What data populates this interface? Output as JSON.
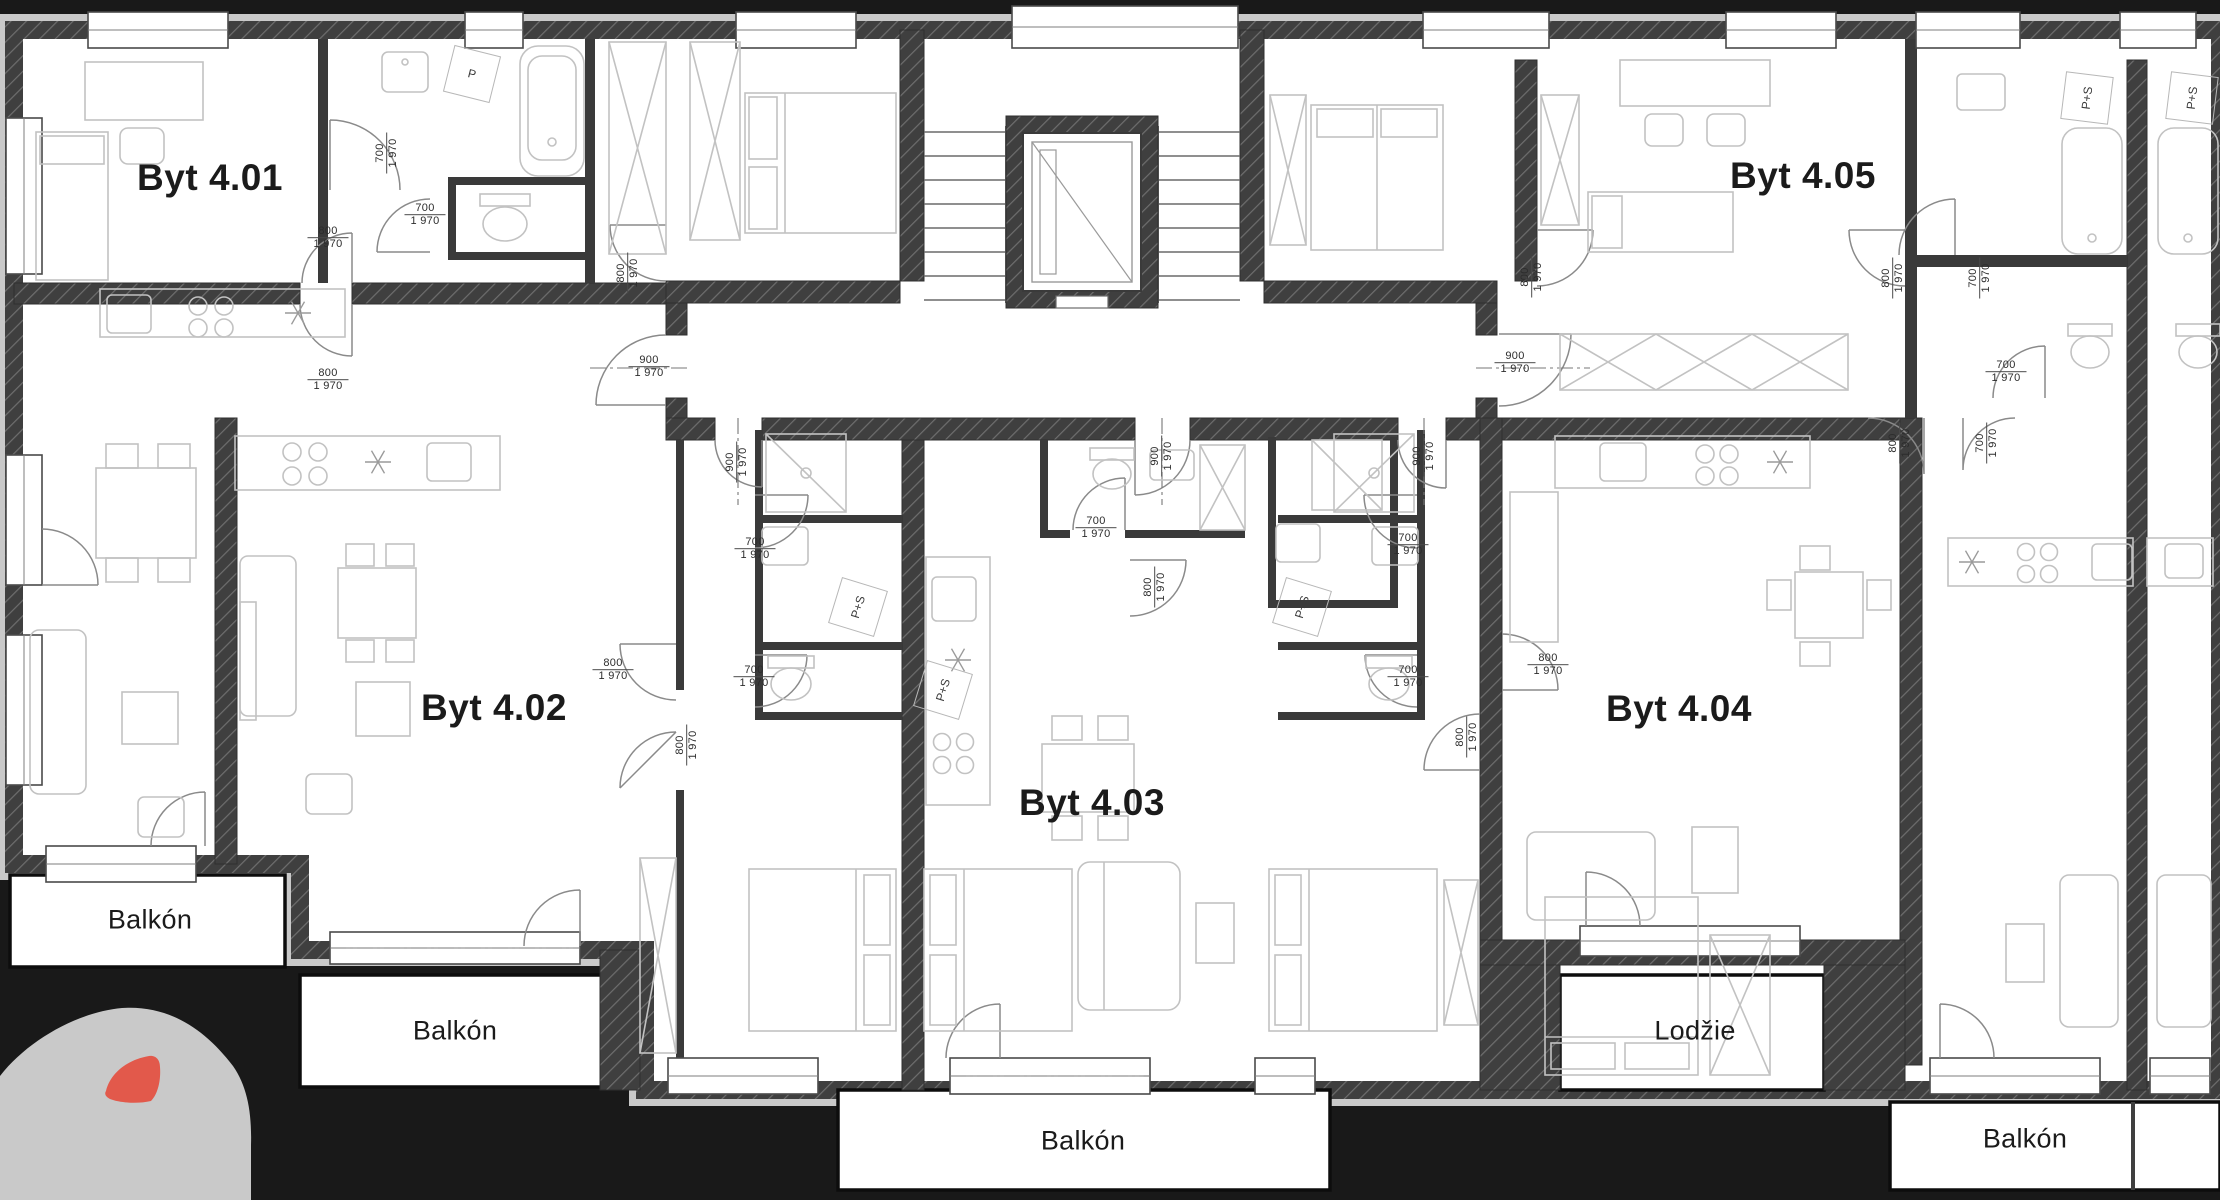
{
  "colors": {
    "background": "#191919",
    "paper": "#ffffff",
    "wall_dark": "#3f3f3f",
    "wall_hatch_line": "#6e6e6e",
    "insulation_band": "#c9c9c9",
    "furniture_line": "#c2c2c2",
    "text": "#1b1b1b",
    "logo_gray": "#c9c9c9",
    "logo_red": "#e2594b"
  },
  "apartments": [
    {
      "label": "Byt 4.01",
      "x": 210,
      "y": 178
    },
    {
      "label": "Byt 4.02",
      "x": 494,
      "y": 708
    },
    {
      "label": "Byt 4.03",
      "x": 1092,
      "y": 803
    },
    {
      "label": "Byt 4.04",
      "x": 1679,
      "y": 709
    },
    {
      "label": "Byt 4.05",
      "x": 1803,
      "y": 176
    }
  ],
  "balconies": [
    {
      "label": "Balkón",
      "x": 150,
      "y": 920
    },
    {
      "label": "Balkón",
      "x": 455,
      "y": 1031
    },
    {
      "label": "Balkón",
      "x": 1083,
      "y": 1141
    },
    {
      "label": "Lodžie",
      "x": 1695,
      "y": 1031
    },
    {
      "label": "Balkón",
      "x": 2025,
      "y": 1139
    }
  ],
  "door_dimensions": [
    {
      "width": "700",
      "height": "1 970",
      "x": 387,
      "y": 153,
      "orientation": "vertical"
    },
    {
      "width": "700",
      "height": "1 970",
      "x": 425,
      "y": 215,
      "orientation": "horizontal"
    },
    {
      "width": "800",
      "height": "1 970",
      "x": 328,
      "y": 238,
      "orientation": "horizontal"
    },
    {
      "width": "800",
      "height": "1 970",
      "x": 628,
      "y": 273,
      "orientation": "vertical"
    },
    {
      "width": "900",
      "height": "1 970",
      "x": 649,
      "y": 367,
      "orientation": "horizontal"
    },
    {
      "width": "800",
      "height": "1 970",
      "x": 328,
      "y": 380,
      "orientation": "horizontal"
    },
    {
      "width": "900",
      "height": "1 970",
      "x": 737,
      "y": 462,
      "orientation": "vertical"
    },
    {
      "width": "700",
      "height": "1 970",
      "x": 755,
      "y": 549,
      "orientation": "horizontal"
    },
    {
      "width": "700",
      "height": "1 970",
      "x": 754,
      "y": 677,
      "orientation": "horizontal"
    },
    {
      "width": "700",
      "height": "1 970",
      "x": 1096,
      "y": 528,
      "orientation": "horizontal"
    },
    {
      "width": "900",
      "height": "1 970",
      "x": 1162,
      "y": 456,
      "orientation": "vertical"
    },
    {
      "width": "800",
      "height": "1 970",
      "x": 1155,
      "y": 587,
      "orientation": "vertical"
    },
    {
      "width": "900",
      "height": "1 970",
      "x": 1424,
      "y": 456,
      "orientation": "vertical"
    },
    {
      "width": "700",
      "height": "1 970",
      "x": 1408,
      "y": 545,
      "orientation": "horizontal"
    },
    {
      "width": "700",
      "height": "1 970",
      "x": 1408,
      "y": 677,
      "orientation": "horizontal"
    },
    {
      "width": "800",
      "height": "1 970",
      "x": 1467,
      "y": 737,
      "orientation": "vertical"
    },
    {
      "width": "800",
      "height": "1 970",
      "x": 613,
      "y": 670,
      "orientation": "horizontal"
    },
    {
      "width": "800",
      "height": "1 970",
      "x": 687,
      "y": 745,
      "orientation": "vertical"
    },
    {
      "width": "800",
      "height": "1 970",
      "x": 1548,
      "y": 665,
      "orientation": "horizontal"
    },
    {
      "width": "800",
      "height": "1 970",
      "x": 1900,
      "y": 443,
      "orientation": "vertical"
    },
    {
      "width": "700",
      "height": "1 970",
      "x": 1987,
      "y": 443,
      "orientation": "vertical"
    },
    {
      "width": "800",
      "height": "1 970",
      "x": 1532,
      "y": 277,
      "orientation": "vertical"
    },
    {
      "width": "800",
      "height": "1 970",
      "x": 1893,
      "y": 278,
      "orientation": "vertical"
    },
    {
      "width": "700",
      "height": "1 970",
      "x": 1980,
      "y": 278,
      "orientation": "vertical"
    },
    {
      "width": "900",
      "height": "1 970",
      "x": 1515,
      "y": 363,
      "orientation": "horizontal"
    },
    {
      "width": "700",
      "height": "1 970",
      "x": 2006,
      "y": 372,
      "orientation": "horizontal"
    }
  ],
  "appliances": [
    {
      "label": "P",
      "x": 472,
      "y": 74,
      "rotation": 14
    },
    {
      "label": "P+S",
      "x": 858,
      "y": 607,
      "rotation": -73
    },
    {
      "label": "P+S",
      "x": 943,
      "y": 690,
      "rotation": -73
    },
    {
      "label": "P+S",
      "x": 1302,
      "y": 607,
      "rotation": -73
    },
    {
      "label": "P+S",
      "x": 2087,
      "y": 98,
      "rotation": -83
    },
    {
      "label": "P+S",
      "x": 2192,
      "y": 98,
      "rotation": -83
    }
  ]
}
